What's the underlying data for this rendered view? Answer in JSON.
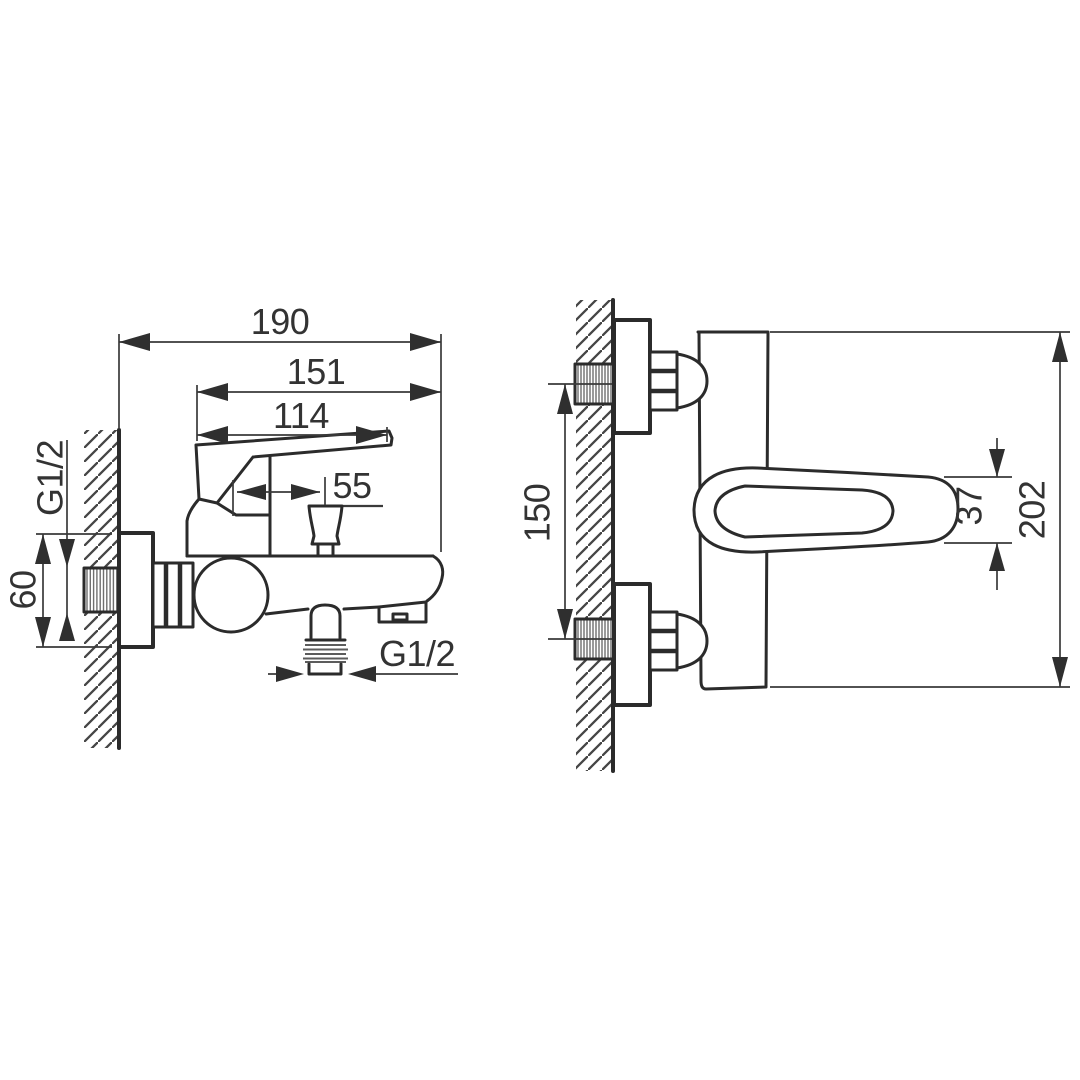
{
  "drawing": {
    "kind": "technical-dimension-drawing",
    "subject": "wall-mounted single-lever bath mixer faucet, two orthographic views",
    "units": "mm",
    "colors": {
      "line": "#2b2b2b",
      "dimension": "#3a3a3a",
      "thread": "#6f6f6f",
      "background": "#ffffff"
    },
    "side_view": {
      "name": "side view (profile against wall)",
      "dims": {
        "overall_depth": "190",
        "upper_depth": "151",
        "lever_depth": "114",
        "diverter_offset": "55",
        "inlet_thread": "G1/2",
        "escutcheon_height": "60",
        "outlet_thread": "G1/2"
      }
    },
    "front_view": {
      "name": "front view (facing wall)",
      "dims": {
        "inlet_spacing": "150",
        "lever_thickness": "37",
        "overall_height": "202"
      }
    }
  }
}
